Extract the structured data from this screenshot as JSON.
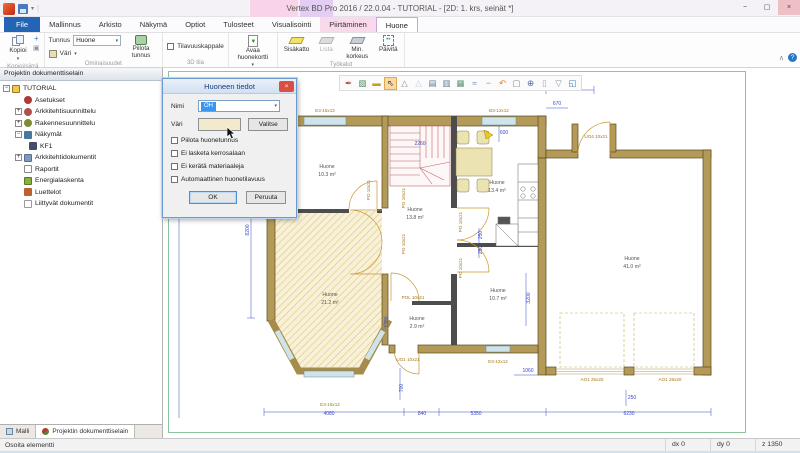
{
  "window": {
    "title": "Vertex BD Pro 2016 / 22.0.04 - TUTORIAL - [2D: 1. krs, seinät *]",
    "controls": {
      "minimize": "−",
      "maximize": "▢",
      "close": "×"
    }
  },
  "menu": {
    "tabs": [
      {
        "label": "File"
      },
      {
        "label": "Mallinnus"
      },
      {
        "label": "Arkisto"
      },
      {
        "label": "Näkymä"
      },
      {
        "label": "Optiot"
      },
      {
        "label": "Tulosteet"
      },
      {
        "label": "Visualisointi"
      },
      {
        "label": "Piirtäminen"
      },
      {
        "label": "Huone"
      }
    ]
  },
  "ribbon": {
    "groups": [
      {
        "label": "Kopioi/siirrä"
      },
      {
        "label": "Ominaisuudet"
      },
      {
        "label": "3D tila"
      },
      {
        "label": ""
      },
      {
        "label": "Työkalut"
      }
    ],
    "copy_button": "Kopioi",
    "tunnus_label": "Tunnus",
    "tunnus_value": "Huone",
    "vari_label": "Väri",
    "piilota_tunnus": "Piilota tunnus",
    "tilavuuskappale": "Tilavuuskappale",
    "avaa_huonekortti": "Avaa huonekortti",
    "tools": [
      "Sisäkatto",
      "Lista",
      "Min. korkeus",
      "Päivitä"
    ]
  },
  "sidebar": {
    "header": "Projektin dokumenttiselain",
    "tree": [
      {
        "label": "TUTORIAL",
        "expand": "−"
      },
      {
        "label": "Asetukset"
      },
      {
        "label": "Arkkitehtisuunnittelu",
        "expand": "+"
      },
      {
        "label": "Rakennesuunnittelu",
        "expand": "+"
      },
      {
        "label": "Näkymät",
        "expand": "−"
      },
      {
        "label": "KF1"
      },
      {
        "label": "Arkkitehtidokumentit",
        "expand": "+"
      },
      {
        "label": "Raportit"
      },
      {
        "label": "Energialaskenta"
      },
      {
        "label": "Luettelot"
      },
      {
        "label": "Liittyvät dokumentit"
      }
    ],
    "tabs": [
      {
        "label": "Malli"
      },
      {
        "label": "Projektin dokumenttiselain"
      }
    ]
  },
  "dialog": {
    "title": "Huoneen tiedot",
    "nimi_label": "Nimi",
    "nimi_value": "OH",
    "vari_label": "Väri",
    "valitse_button": "Valitse",
    "checkboxes": [
      {
        "label": "Piilota huonetunnus",
        "checked": false
      },
      {
        "label": "Ei lasketa kerrosalaan",
        "checked": false
      },
      {
        "label": "Ei kerätä materiaaleja",
        "checked": false
      },
      {
        "label": "Automaattinen huonetilavuus",
        "checked": false
      }
    ],
    "ok_button": "OK",
    "cancel_button": "Peruuta"
  },
  "canvas": {
    "toolbar": {
      "icons": [
        {
          "name": "pin-icon",
          "glyph": "✒",
          "color": "#b05040"
        },
        {
          "name": "select-box-icon",
          "glyph": "▧",
          "color": "#4a8a5a"
        },
        {
          "name": "measure-icon",
          "glyph": "▬",
          "color": "#c8a020"
        },
        {
          "name": "cursor-icon",
          "glyph": "⇖",
          "color": "#444",
          "active": true
        },
        {
          "name": "triangle-icon",
          "glyph": "△",
          "color": "#8a94a0"
        },
        {
          "name": "triangle-alt-icon",
          "glyph": "△",
          "color": "#c4cad2"
        },
        {
          "name": "layers-icon",
          "glyph": "▤",
          "color": "#5a7890"
        },
        {
          "name": "layers2-icon",
          "glyph": "▥",
          "color": "#5a7890"
        },
        {
          "name": "layers3-icon",
          "glyph": "▦",
          "color": "#5a9070"
        },
        {
          "name": "waves-icon",
          "glyph": "≈",
          "color": "#6a86b0"
        },
        {
          "name": "line-icon",
          "glyph": "−",
          "color": "#888"
        },
        {
          "name": "undo-icon",
          "glyph": "↶",
          "color": "#e07820"
        },
        {
          "name": "zoom-area-icon",
          "glyph": "▢",
          "color": "#7a8694"
        },
        {
          "name": "zoom-icon",
          "glyph": "⊕",
          "color": "#4a6a9a"
        },
        {
          "name": "sheet-icon",
          "glyph": "▯",
          "color": "#9aa4b0"
        },
        {
          "name": "filter-icon",
          "glyph": "▽",
          "color": "#8a94a0"
        },
        {
          "name": "external-view-icon",
          "glyph": "◱",
          "color": "#3a7ac0"
        }
      ]
    },
    "plan": {
      "labels": [
        {
          "text": "Huone",
          "x": 163,
          "y": 100,
          "c": "room"
        },
        {
          "text": "10.3 m²",
          "x": 163,
          "y": 108,
          "c": "room"
        },
        {
          "text": "Huone",
          "x": 166,
          "y": 228,
          "c": "room"
        },
        {
          "text": "21.2 m²",
          "x": 166,
          "y": 236,
          "c": "room"
        },
        {
          "text": "Huone",
          "x": 251,
          "y": 143,
          "c": "room"
        },
        {
          "text": "13.8 m²",
          "x": 251,
          "y": 151,
          "c": "room"
        },
        {
          "text": "Huone",
          "x": 333,
          "y": 116,
          "c": "room"
        },
        {
          "text": "13.4 m²",
          "x": 333,
          "y": 124,
          "c": "room"
        },
        {
          "text": "Huone",
          "x": 253,
          "y": 252,
          "c": "room"
        },
        {
          "text": "2.9 m²",
          "x": 253,
          "y": 260,
          "c": "room"
        },
        {
          "text": "Huone",
          "x": 334,
          "y": 224,
          "c": "room"
        },
        {
          "text": "10.7 m²",
          "x": 334,
          "y": 232,
          "c": "room"
        },
        {
          "text": "Huone",
          "x": 468,
          "y": 192,
          "c": "room"
        },
        {
          "text": "41.0 m²",
          "x": 468,
          "y": 200,
          "c": "room"
        },
        {
          "text": "E3-15x12",
          "x": 161,
          "y": 44,
          "c": "code"
        },
        {
          "text": "B3-12x12",
          "x": 335,
          "y": 44,
          "c": "code"
        },
        {
          "text": "600",
          "x": 340,
          "y": 66,
          "c": "dim"
        },
        {
          "text": "1300",
          "x": 408,
          "y": 17,
          "c": "dim"
        },
        {
          "text": "670",
          "x": 393,
          "y": 37,
          "c": "dim"
        },
        {
          "text": "UO4 10x21",
          "x": 432,
          "y": 70,
          "c": "code"
        },
        {
          "text": "2260",
          "x": 256,
          "y": 77,
          "c": "dim"
        },
        {
          "text": "PO 10x21",
          "x": 241,
          "y": 130,
          "rot": -90,
          "c": "code"
        },
        {
          "text": "PO 10x21",
          "x": 241,
          "y": 176,
          "rot": -90,
          "c": "code"
        },
        {
          "text": "PO 10x21",
          "x": 206,
          "y": 122,
          "rot": -90,
          "c": "code"
        },
        {
          "text": "PO 10x21",
          "x": 298,
          "y": 154,
          "rot": -90,
          "c": "code"
        },
        {
          "text": "PO 10x21",
          "x": 298,
          "y": 200,
          "rot": -90,
          "c": "code"
        },
        {
          "text": "250",
          "x": 318,
          "y": 167,
          "rot": -90,
          "c": "dim"
        },
        {
          "text": "250",
          "x": 318,
          "y": 182,
          "rot": -90,
          "c": "dim"
        },
        {
          "text": "1380",
          "x": 224,
          "y": 254,
          "rot": -90,
          "c": "dim"
        },
        {
          "text": "POL 10x21",
          "x": 249,
          "y": 231,
          "c": "code"
        },
        {
          "text": "UO1 10x21",
          "x": 244,
          "y": 293,
          "c": "code"
        },
        {
          "text": "700",
          "x": 239,
          "y": 320,
          "rot": -90,
          "c": "dim"
        },
        {
          "text": "E3-12x12",
          "x": 334,
          "y": 295,
          "c": "code"
        },
        {
          "text": "3200",
          "x": 366,
          "y": 230,
          "rot": -90,
          "c": "dim"
        },
        {
          "text": "1060",
          "x": 364,
          "y": 304,
          "c": "dim"
        },
        {
          "text": "AO1 25x20",
          "x": 428,
          "y": 313,
          "c": "code"
        },
        {
          "text": "AO1 25x20",
          "x": 506,
          "y": 313,
          "c": "code"
        },
        {
          "text": "250",
          "x": 468,
          "y": 331,
          "c": "dim"
        },
        {
          "text": "E3-15x12",
          "x": 166,
          "y": 338,
          "c": "code"
        },
        {
          "text": "4080",
          "x": 165,
          "y": 347,
          "c": "dim"
        },
        {
          "text": "840",
          "x": 258,
          "y": 347,
          "c": "dim"
        },
        {
          "text": "5350",
          "x": 312,
          "y": 347,
          "c": "dim"
        },
        {
          "text": "6230",
          "x": 465,
          "y": 347,
          "c": "dim"
        },
        {
          "text": "8200",
          "x": 85,
          "y": 162,
          "rot": -90,
          "c": "dim"
        }
      ]
    }
  },
  "statusbar": {
    "hint": "Osoita elementti",
    "cells": [
      "dx 0",
      "dy 0",
      "z 1350"
    ]
  }
}
